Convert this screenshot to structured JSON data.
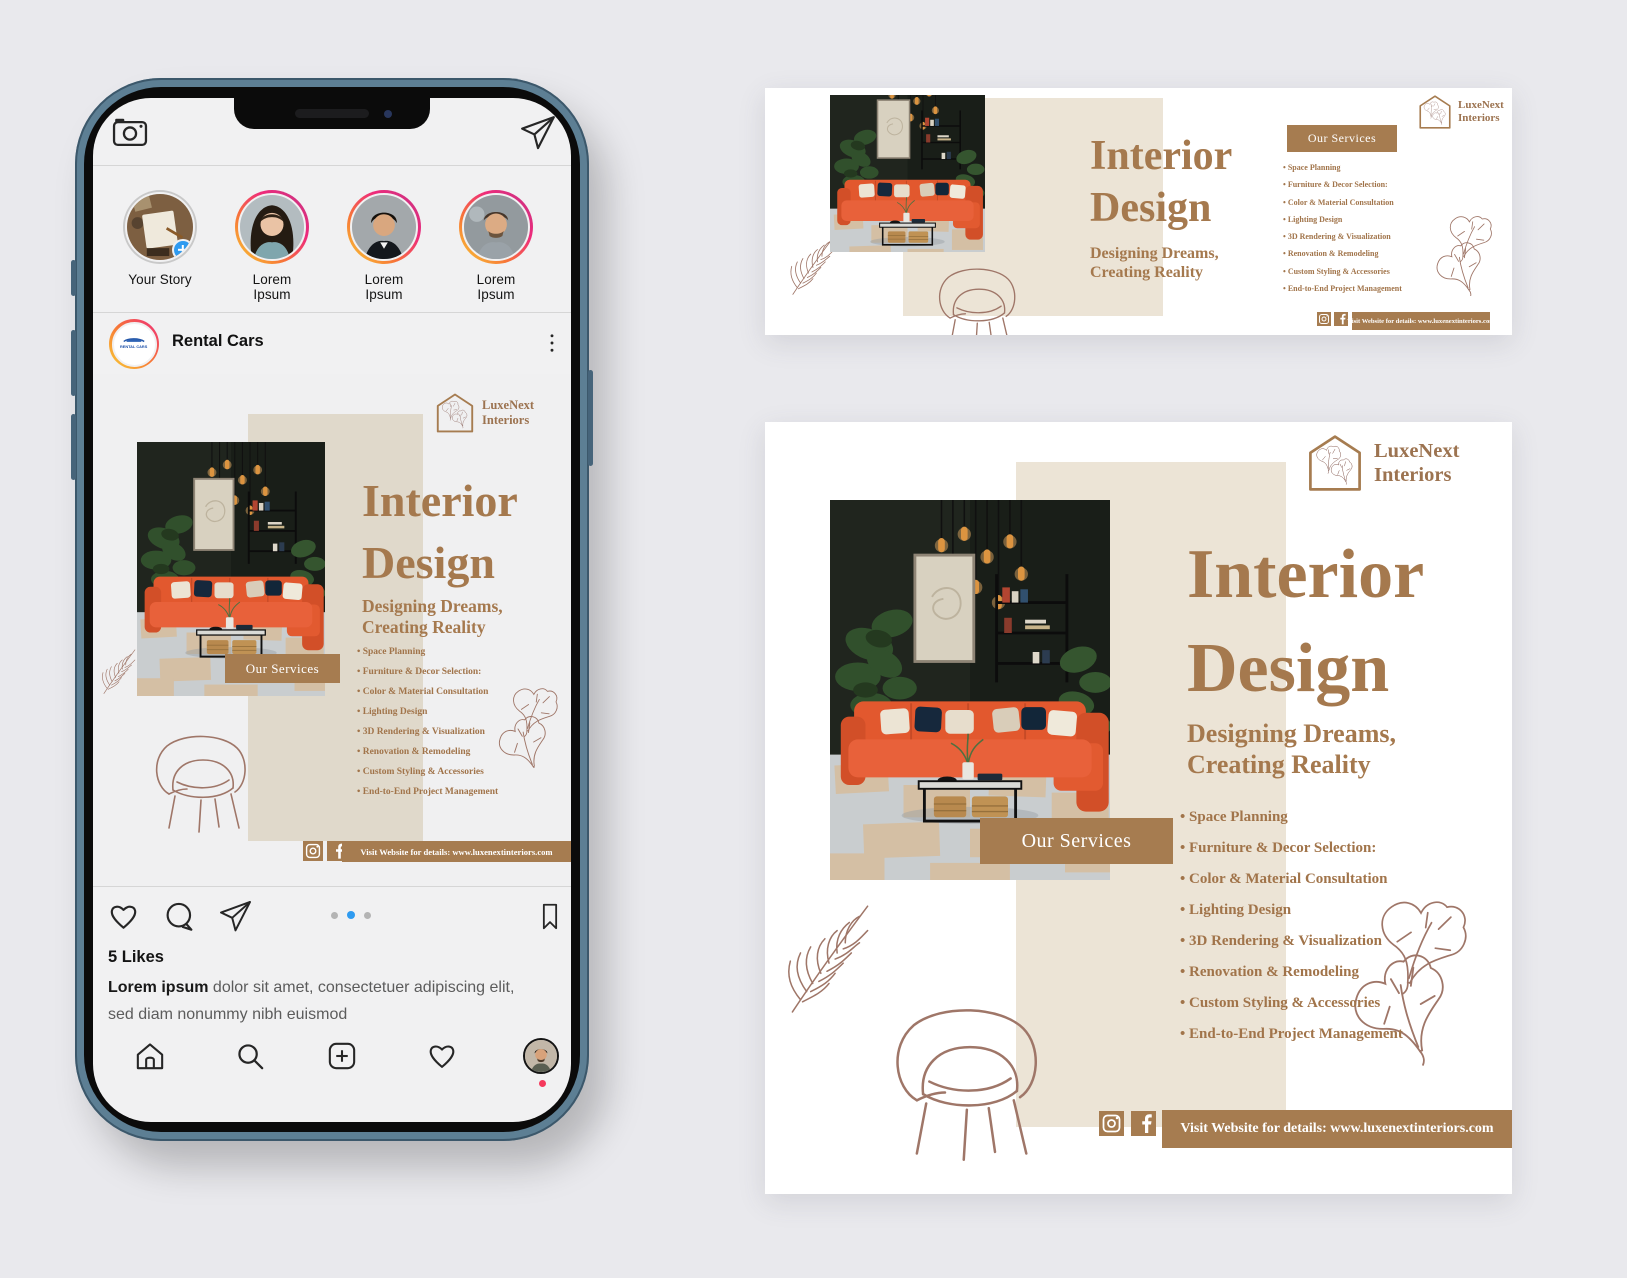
{
  "page": {
    "background": "#e9e9ed"
  },
  "ad": {
    "brand_line1": "LuxeNext",
    "brand_line2": "Interiors",
    "title_line1": "Interior",
    "title_line2": "Design",
    "subtitle_line1": "Designing Dreams,",
    "subtitle_line2": "Creating Reality",
    "services_button": "Our Services",
    "services": [
      "Space Planning",
      "Furniture & Decor Selection:",
      "Color & Material Consultation",
      "Lighting Design",
      "3D Rendering & Visualization",
      "Renovation & Remodeling",
      "Custom Styling & Accessories",
      "End-to-End Project Management"
    ],
    "website_bar": "Visit Website for details: www.luxenextinteriors.com",
    "colors": {
      "accent_brown": "#a67c50",
      "title_brown": "#a5794e",
      "beige_panel": "#ece4d6",
      "line_art": "#9f7668"
    }
  },
  "instagram": {
    "stories": [
      {
        "label": "Your Story"
      },
      {
        "label": "Lorem Ipsum"
      },
      {
        "label": "Lorem Ipsum"
      },
      {
        "label": "Lorem Ipsum"
      }
    ],
    "post": {
      "username": "Rental Cars",
      "avatar_text": "RENTAL CARS",
      "likes": "5 Likes",
      "caption_lead": "Lorem ipsum",
      "caption_rest": " dolor sit amet, consectetuer adipiscing elit, sed diam nonummy nibh euismod"
    },
    "carousel": {
      "dot_count": 3,
      "active_dot": 2
    }
  }
}
